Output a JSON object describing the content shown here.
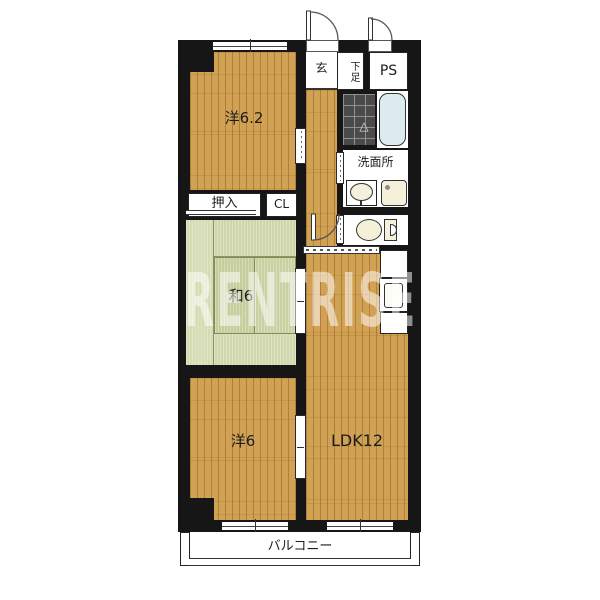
{
  "floorplan": {
    "watermark": "RENTRISE",
    "labels": {
      "room_west_top": "洋6.2",
      "room_west_bottom": "洋6",
      "room_japanese": "和6",
      "room_ldk": "LDK12",
      "entrance": "玄",
      "shoe_cabinet": "下足",
      "pipe_space": "PS",
      "washroom": "洗面所",
      "closet_oshiire": "押入",
      "closet_cl": "CL",
      "balcony": "バルコニー"
    },
    "icons": {
      "bath_drain_marker": "△"
    },
    "colors": {
      "wall": "#161616",
      "wood_floor": "#d2a254",
      "tatami": "#ccd4a8",
      "bathtub": "#dcecee",
      "bath_tile": "#4a4a4a",
      "fixture": "#f4f0da",
      "watermark": "rgba(255,255,255,0.52)"
    }
  }
}
